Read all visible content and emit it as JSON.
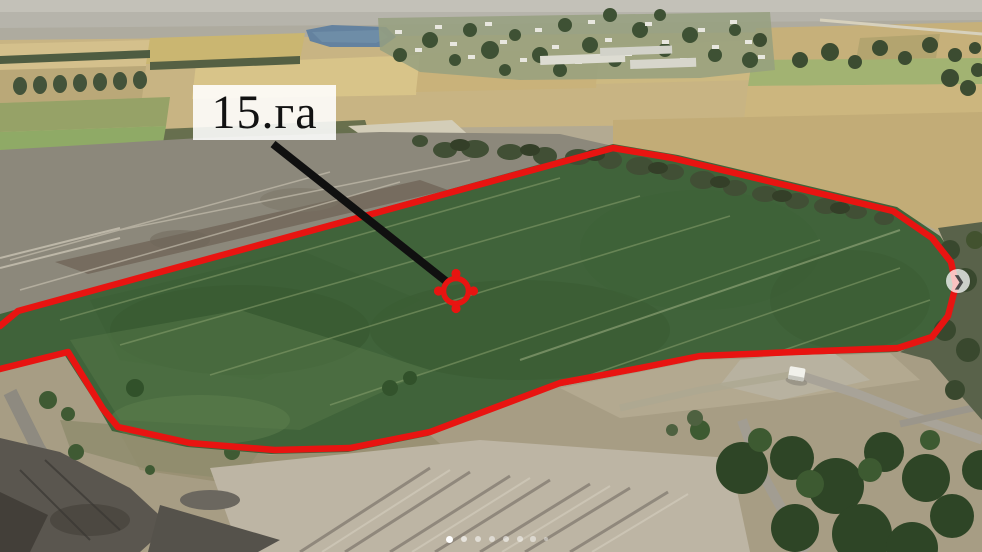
{
  "annotation": {
    "area_label": "15.га",
    "label_bg": "rgba(255,255,255,0.88)",
    "label_text_color": "#121212",
    "outline_color": "#e81411",
    "pointer_color": "#101010",
    "marker_color": "#e81411",
    "outline_points": "0,326 18,311 613,148 672,158 893,211 932,238 951,262 956,285 948,316 932,337 898,348 795,352 700,356 640,368 560,383 430,432 350,448 275,450 190,443 118,427 103,409 68,352 0,369",
    "pointer_points": "273,144 447,282",
    "marker_transform": "translate(456,291)"
  },
  "carousel": {
    "next_glyph": "❯",
    "active_dot_index": 0,
    "dots": [
      {
        "x": 449,
        "y": 539,
        "r": 3.5,
        "opacity": 1
      },
      {
        "x": 464,
        "y": 539,
        "r": 3.0,
        "opacity": 0.62
      },
      {
        "x": 478,
        "y": 539,
        "r": 3.0,
        "opacity": 0.55
      },
      {
        "x": 492,
        "y": 539,
        "r": 2.9,
        "opacity": 0.5
      },
      {
        "x": 506,
        "y": 539,
        "r": 2.9,
        "opacity": 0.55
      },
      {
        "x": 520,
        "y": 539,
        "r": 2.8,
        "opacity": 0.5
      },
      {
        "x": 533,
        "y": 539,
        "r": 2.7,
        "opacity": 0.48
      },
      {
        "x": 546,
        "y": 539,
        "r": 2.4,
        "opacity": 0.42
      }
    ]
  },
  "scene": {
    "description": "Drone aerial photo: a 15-hectare green field outlined in red, distant village with pond and wheat fields at top, excavated gravel ground and trees in the foreground, white van on a dirt road.",
    "field_green": "#40633a",
    "wheat_tan": "#c8b483",
    "pond_blue": "#64829f",
    "gravel_gray": "#a79d84"
  }
}
